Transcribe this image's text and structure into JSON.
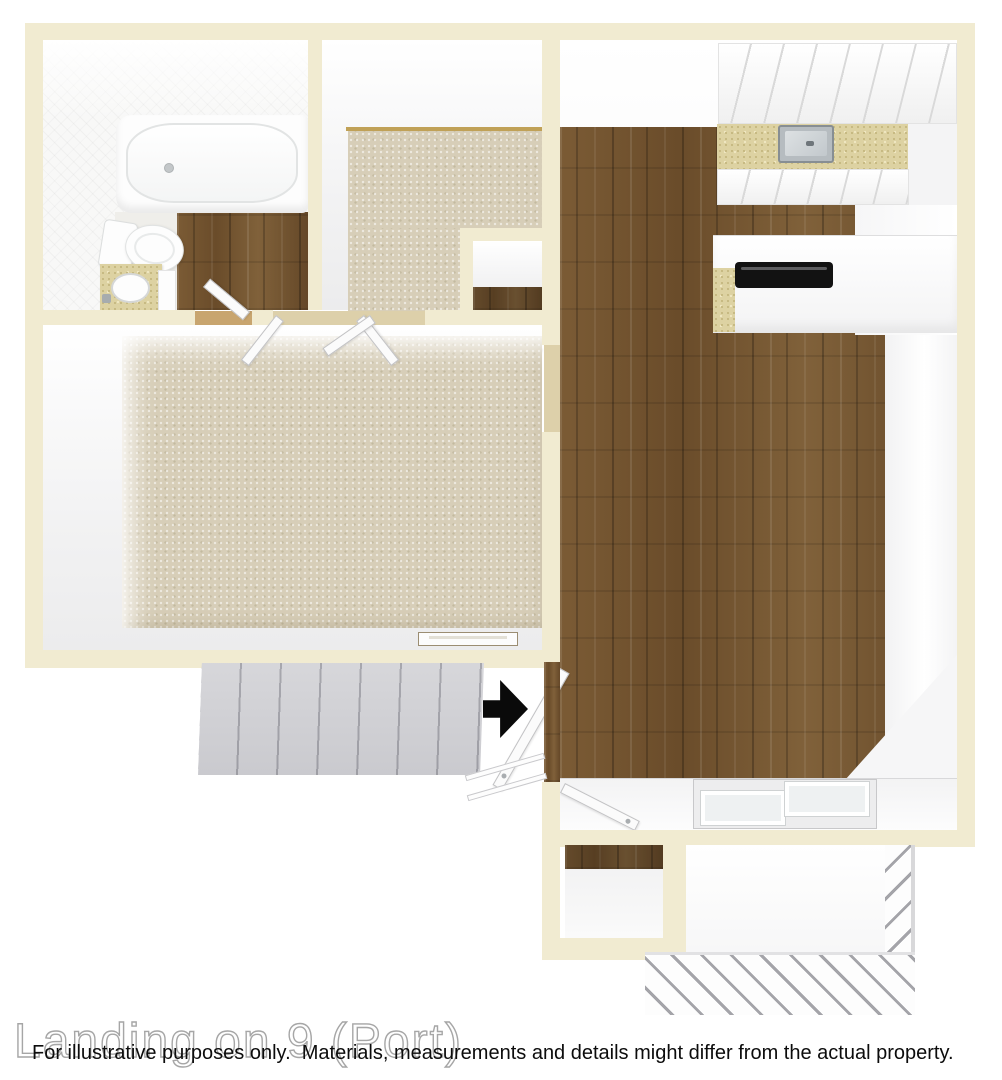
{
  "watermark": {
    "text": "Landing on 9 (Port)"
  },
  "disclaimer": {
    "text": "For illustrative purposes only.  Materials, measurements and details might differ from the actual property."
  },
  "fixtures": {
    "entry_arrow": "arrow-right-icon",
    "items": [
      "bathtub",
      "toilet",
      "bathroom-vanity-sink",
      "kitchen-sink",
      "stove-cooktop",
      "kitchen-cabinets",
      "stairs",
      "stair-railing",
      "sliding-glass-door",
      "entry-doors",
      "closet-double-doors",
      "balcony-railing",
      "baseboard-vent"
    ]
  },
  "colors": {
    "wall": "#f1ebd1",
    "wood_floor": "#6f512e",
    "carpet": "#d7ceb8",
    "countertop_speckle": "#ddd2a2",
    "stairs": "#e7e7e9",
    "entry_arrow": "#0a0a0a",
    "interior_white": "#ffffff",
    "disclaimer_text": "#0c0c0c",
    "watermark_outline": "#a6a6a6"
  }
}
